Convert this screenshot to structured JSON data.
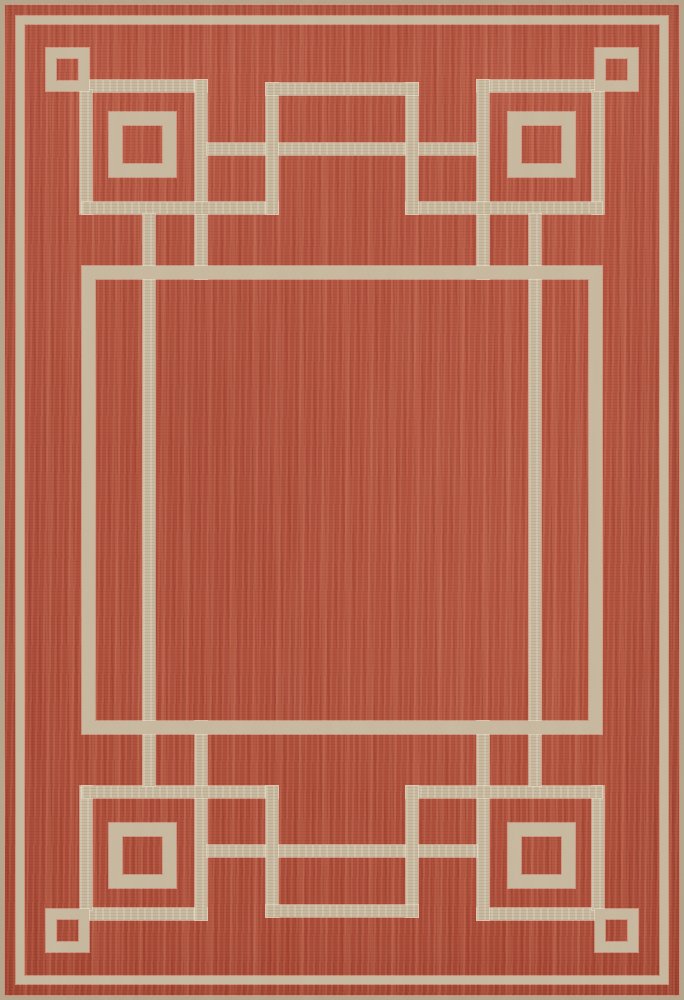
{
  "scene": {
    "subject": "rectangular flat-weave area rug, overhead product photo",
    "field_color_name": "terracotta red",
    "pattern_color_name": "taupe / beige",
    "pattern_style": "Greek-key geometric border with corner squares and inner frame"
  },
  "canvas": {
    "width": 684,
    "height": 1000
  },
  "palette": {
    "field": "#b04c38",
    "band": "#c5b69c",
    "band_light": "#eee3cb",
    "binding": "#b3a288"
  },
  "pattern": {
    "frames": [
      {
        "name": "edge-binding",
        "x": 0,
        "y": 0,
        "w": 684,
        "h": 1000,
        "t": 4,
        "tone": "binding"
      },
      {
        "name": "outer-border-line",
        "x": 16,
        "y": 16,
        "w": 652,
        "h": 968,
        "t": 8,
        "tone": "band"
      },
      {
        "name": "corner-small-square-tl",
        "x": 46,
        "y": 48,
        "w": 43,
        "h": 43,
        "t": 10,
        "tone": "band"
      },
      {
        "name": "corner-small-square-tr",
        "x": 595,
        "y": 48,
        "w": 43,
        "h": 43,
        "t": 10,
        "tone": "band"
      },
      {
        "name": "corner-small-square-bl",
        "x": 46,
        "y": 909,
        "w": 43,
        "h": 43,
        "t": 10,
        "tone": "band"
      },
      {
        "name": "corner-small-square-br",
        "x": 595,
        "y": 909,
        "w": 43,
        "h": 43,
        "t": 10,
        "tone": "band"
      },
      {
        "name": "corner-large-square-tl",
        "x": 109,
        "y": 112,
        "w": 67,
        "h": 65,
        "t": 13,
        "tone": "band"
      },
      {
        "name": "corner-large-square-tr",
        "x": 508,
        "y": 112,
        "w": 67,
        "h": 65,
        "t": 13,
        "tone": "band"
      },
      {
        "name": "corner-large-square-bl",
        "x": 109,
        "y": 823,
        "w": 67,
        "h": 65,
        "t": 13,
        "tone": "band"
      },
      {
        "name": "corner-large-square-br",
        "x": 508,
        "y": 823,
        "w": 67,
        "h": 65,
        "t": 13,
        "tone": "band"
      },
      {
        "name": "inner-field-frame",
        "x": 82,
        "y": 266,
        "w": 520,
        "h": 468,
        "t": 13,
        "tone": "band"
      }
    ],
    "bars": [
      {
        "name": "corner-arm-horizontal-tl",
        "x": 88,
        "y": 80,
        "w": 119,
        "h": 12
      },
      {
        "name": "corner-arm-horizontal-tr",
        "x": 477,
        "y": 80,
        "w": 119,
        "h": 12
      },
      {
        "name": "corner-arm-horizontal-bl",
        "x": 88,
        "y": 908,
        "w": 119,
        "h": 12
      },
      {
        "name": "corner-arm-horizontal-br",
        "x": 477,
        "y": 908,
        "w": 119,
        "h": 12
      },
      {
        "name": "corner-arm-vertical-tl",
        "x": 80,
        "y": 90,
        "w": 12,
        "h": 124
      },
      {
        "name": "corner-arm-vertical-tr",
        "x": 592,
        "y": 90,
        "w": 12,
        "h": 124
      },
      {
        "name": "corner-arm-vertical-bl",
        "x": 80,
        "y": 786,
        "w": 12,
        "h": 124
      },
      {
        "name": "corner-arm-vertical-br",
        "x": 592,
        "y": 786,
        "w": 12,
        "h": 124
      },
      {
        "name": "corner-key-vertical-tl",
        "x": 195,
        "y": 80,
        "w": 12,
        "h": 199
      },
      {
        "name": "corner-key-vertical-tr",
        "x": 477,
        "y": 80,
        "w": 12,
        "h": 199
      },
      {
        "name": "corner-key-vertical-bl",
        "x": 195,
        "y": 721,
        "w": 12,
        "h": 199
      },
      {
        "name": "corner-key-vertical-br",
        "x": 477,
        "y": 721,
        "w": 12,
        "h": 199
      },
      {
        "name": "corner-key-horizontal-tl",
        "x": 82,
        "y": 202,
        "w": 196,
        "h": 12
      },
      {
        "name": "corner-key-horizontal-tr",
        "x": 406,
        "y": 202,
        "w": 196,
        "h": 12
      },
      {
        "name": "corner-key-horizontal-bl",
        "x": 82,
        "y": 786,
        "w": 196,
        "h": 12
      },
      {
        "name": "corner-key-horizontal-br",
        "x": 406,
        "y": 786,
        "w": 196,
        "h": 12
      },
      {
        "name": "top-border-bar",
        "x": 207,
        "y": 143,
        "w": 270,
        "h": 12
      },
      {
        "name": "bottom-border-bar",
        "x": 207,
        "y": 845,
        "w": 270,
        "h": 12
      },
      {
        "name": "top-bump-vertical-left",
        "x": 266,
        "y": 83,
        "w": 12,
        "h": 131
      },
      {
        "name": "top-bump-vertical-right",
        "x": 406,
        "y": 83,
        "w": 12,
        "h": 131
      },
      {
        "name": "bottom-bump-vertical-left",
        "x": 266,
        "y": 786,
        "w": 12,
        "h": 131
      },
      {
        "name": "bottom-bump-vertical-right",
        "x": 406,
        "y": 786,
        "w": 12,
        "h": 131
      },
      {
        "name": "top-bump-bar",
        "x": 266,
        "y": 83,
        "w": 152,
        "h": 12
      },
      {
        "name": "bottom-bump-bar",
        "x": 266,
        "y": 905,
        "w": 152,
        "h": 12
      },
      {
        "name": "side-rail-left",
        "x": 143,
        "y": 214,
        "w": 12,
        "h": 572
      },
      {
        "name": "side-rail-right",
        "x": 529,
        "y": 214,
        "w": 12,
        "h": 572
      }
    ]
  }
}
